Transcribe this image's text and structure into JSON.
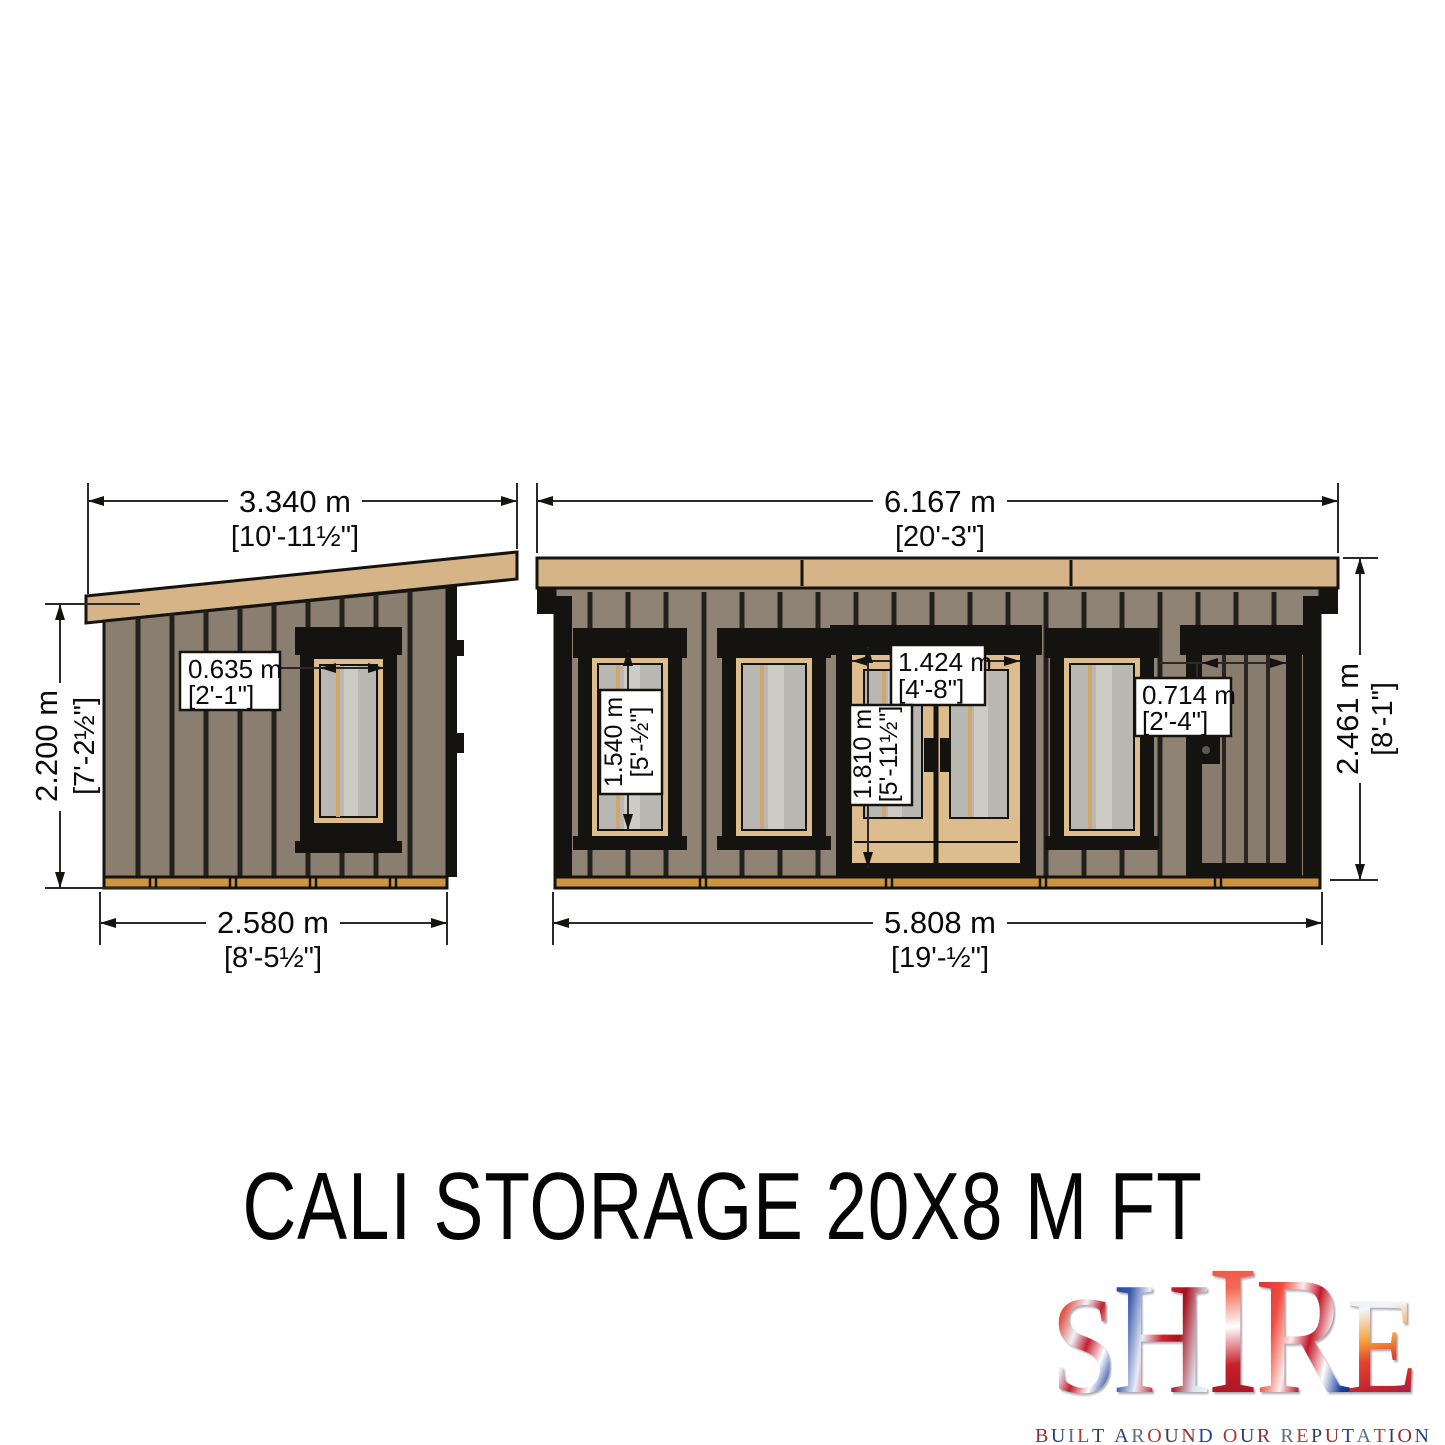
{
  "title": "CALI STORAGE 20X8 M FT",
  "views": {
    "side": {
      "overall_width": {
        "m": "3.340 m",
        "ft": "[10'-11½\"]"
      },
      "wall_height": {
        "m": "2.200 m",
        "ft": "[7'-2½\"]"
      },
      "base_width": {
        "m": "2.580 m",
        "ft": "[8'-5½\"]"
      },
      "window_width": {
        "m": "0.635 m",
        "ft": "[2'-1\"]"
      }
    },
    "front": {
      "overall_width": {
        "m": "6.167 m",
        "ft": "[20'-3\"]"
      },
      "overall_height": {
        "m": "2.461 m",
        "ft": "[8'-1\"]"
      },
      "base_width": {
        "m": "5.808 m",
        "ft": "[19'-½\"]"
      },
      "window_height": {
        "m": "1.540 m",
        "ft": "[5'-½\"]"
      },
      "door_width": {
        "m": "1.424 m",
        "ft": "[4'-8\"]"
      },
      "door_height": {
        "m": "1.810 m",
        "ft": "[5'-11½\"]"
      },
      "side_door_width": {
        "m": "0.714 m",
        "ft": "[2'-4\"]"
      }
    }
  },
  "logo": {
    "brand": "SHIRE",
    "letters": [
      "S",
      "H",
      "I",
      "R",
      "E"
    ],
    "tagline": "BUILT AROUND OUR REPUTATION"
  },
  "colors": {
    "roof_timber": "#d7b488",
    "wall_cladding": "#8e8374",
    "side_wall_cladding": "#897e6f",
    "door_plank": "#877c6d",
    "base_timber": "#cc9440",
    "frame_black": "#15130f",
    "frame_tan": "#ddbc8d",
    "glass": "#b9b7b2"
  }
}
